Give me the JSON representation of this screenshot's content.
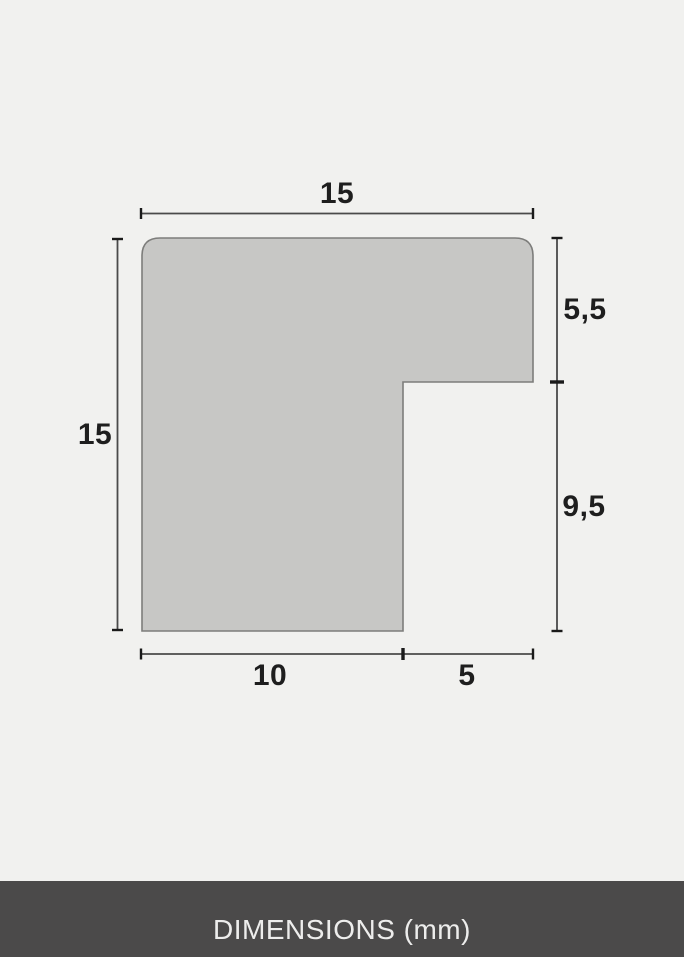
{
  "diagram": {
    "title": "Frame moulding profile cross-section",
    "unit_label": "DIMENSIONS (mm)",
    "dimensions": {
      "top_width": "15",
      "left_height": "15",
      "right_upper_height": "5,5",
      "right_lower_height": "9,5",
      "bottom_left_width": "10",
      "bottom_right_width": "5"
    },
    "colors": {
      "background": "#f1f1ef",
      "shape_fill": "#c7c7c5",
      "shape_border": "#7d7d7b",
      "dim_line": "#4a4a4a",
      "tick": "#1a1a1a",
      "label": "#1e1e1e",
      "footer_bg": "#4b4a4a",
      "footer_text": "#ededec"
    }
  }
}
